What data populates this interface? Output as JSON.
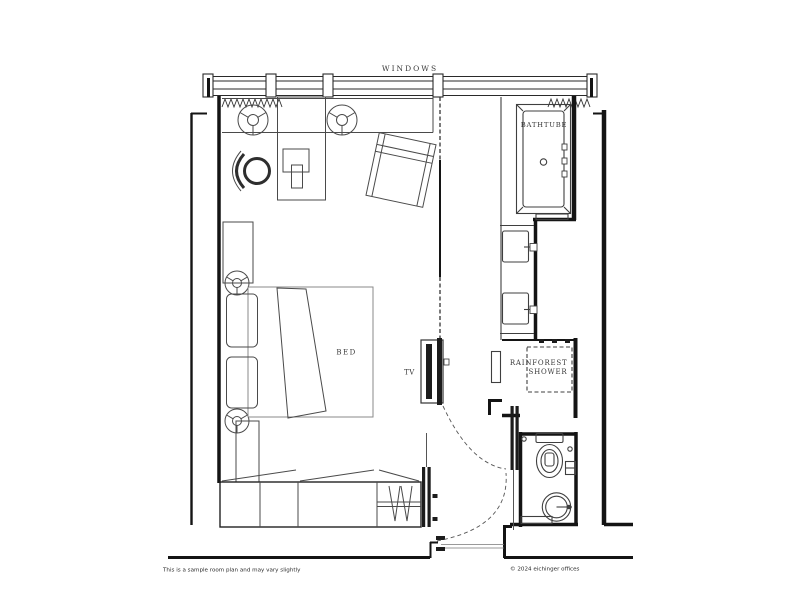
{
  "plan": {
    "labels": {
      "windows": "WINDOWS",
      "bathtub": "BATHTUBE",
      "bed": "BED",
      "tv": "TV",
      "shower_line1": "RAINFOREST",
      "shower_line2": "SHOWER"
    },
    "footer": {
      "disclaimer": "This is a sample room plan and may vary slightly",
      "copyright": "© 2024 eichinger offices"
    },
    "colors": {
      "background": "#ffffff",
      "wall": "#141414",
      "furniture": "#4a4a4a",
      "fixture": "#3f3f3f",
      "label": "#383838",
      "dashed_lines": "#555555"
    }
  }
}
